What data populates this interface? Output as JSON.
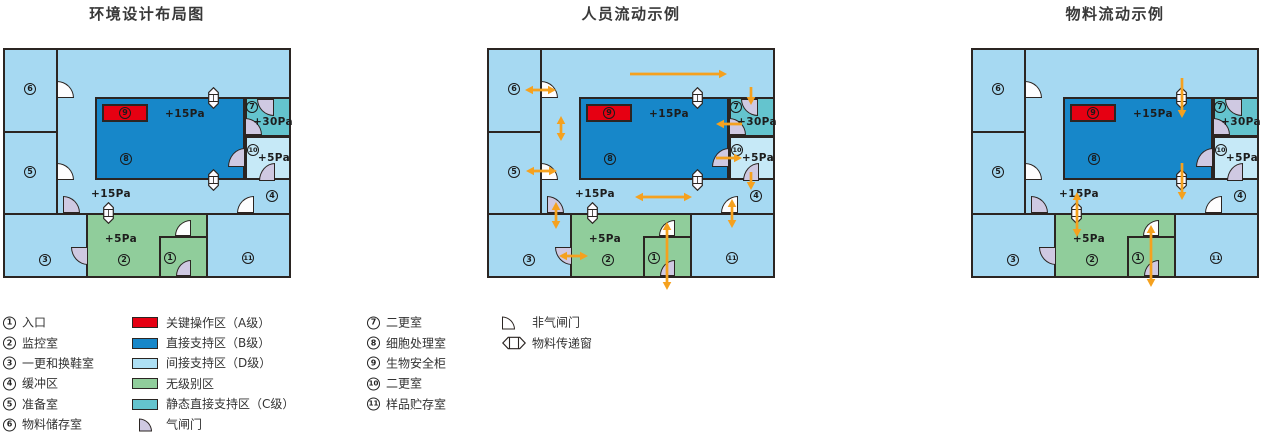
{
  "colors": {
    "wall": "#2B2522",
    "light_blue": "#A6D9F2",
    "lighter_blue": "#C6E9F7",
    "dark_blue": "#1787C9",
    "teal": "#64C4CE",
    "green": "#90CD9B",
    "red": "#E60012",
    "door_purple": "#CFC9E2",
    "door_white": "#FDFDFE",
    "arrow": "#F5A11E",
    "swatch_light_blue": "#AEE0F5",
    "title_text": "#383838"
  },
  "panels": [
    {
      "title": "环境设计布局图",
      "arrows": []
    },
    {
      "title": "人员流动示例",
      "arrows": [
        {
          "x1": 143,
          "y1": 26,
          "x2": 240,
          "y2": 26,
          "heads": "end"
        },
        {
          "x1": 38,
          "y1": 42,
          "x2": 69,
          "y2": 42,
          "heads": "both"
        },
        {
          "x1": 74,
          "y1": 68,
          "x2": 74,
          "y2": 93,
          "heads": "both"
        },
        {
          "x1": 39,
          "y1": 123,
          "x2": 70,
          "y2": 123,
          "heads": "both"
        },
        {
          "x1": 69,
          "y1": 154,
          "x2": 69,
          "y2": 181,
          "heads": "both"
        },
        {
          "x1": 72,
          "y1": 208,
          "x2": 101,
          "y2": 208,
          "heads": "both"
        },
        {
          "x1": 264,
          "y1": 39,
          "x2": 264,
          "y2": 57,
          "heads": "end"
        },
        {
          "x1": 255,
          "y1": 76,
          "x2": 229,
          "y2": 76,
          "heads": "end"
        },
        {
          "x1": 229,
          "y1": 110,
          "x2": 255,
          "y2": 110,
          "heads": "end"
        },
        {
          "x1": 264,
          "y1": 124,
          "x2": 264,
          "y2": 142,
          "heads": "end"
        },
        {
          "x1": 148,
          "y1": 149,
          "x2": 205,
          "y2": 149,
          "heads": "both"
        },
        {
          "x1": 245,
          "y1": 151,
          "x2": 245,
          "y2": 180,
          "heads": "both"
        },
        {
          "x1": 180,
          "y1": 174,
          "x2": 180,
          "y2": 242,
          "heads": "both"
        }
      ]
    },
    {
      "title": "物料流动示例",
      "arrows": [
        {
          "x1": 211,
          "y1": 30,
          "x2": 211,
          "y2": 70,
          "heads": "end"
        },
        {
          "x1": 211,
          "y1": 115,
          "x2": 211,
          "y2": 152,
          "heads": "end"
        },
        {
          "x1": 106,
          "y1": 144,
          "x2": 106,
          "y2": 189,
          "heads": "both"
        },
        {
          "x1": 180,
          "y1": 177,
          "x2": 180,
          "y2": 239,
          "heads": "both"
        }
      ]
    }
  ],
  "plan": {
    "zones": [
      {
        "name": "zone-indirect-support-d",
        "color": "light_blue",
        "x": 0,
        "y": 0,
        "w": 288,
        "h": 230,
        "outlined": false
      },
      {
        "name": "zone-unclassified",
        "color": "green",
        "x": 84,
        "y": 166,
        "w": 120,
        "h": 64,
        "outlined": false
      },
      {
        "name": "zone-direct-support-b",
        "color": "dark_blue",
        "x": 92,
        "y": 49,
        "w": 150,
        "h": 83,
        "outlined": true
      },
      {
        "name": "zone-static-direct-support-c",
        "color": "teal",
        "x": 242,
        "y": 49,
        "w": 46,
        "h": 40,
        "outlined": true
      },
      {
        "name": "zone-changing-room-10",
        "color": "lighter_blue",
        "x": 242,
        "y": 88,
        "w": 46,
        "h": 44,
        "outlined": true
      },
      {
        "name": "zone-critical-operation-a",
        "color": "red",
        "x": 99,
        "y": 56,
        "w": 46,
        "h": 18,
        "outlined": true
      }
    ],
    "walls": [
      {
        "x": 53,
        "y": 0,
        "w": 2,
        "h": 167
      },
      {
        "x": 0,
        "y": 83,
        "w": 55,
        "h": 2
      },
      {
        "x": 0,
        "y": 165,
        "w": 288,
        "h": 2
      },
      {
        "x": 83,
        "y": 165,
        "w": 2,
        "h": 65
      },
      {
        "x": 203,
        "y": 165,
        "w": 2,
        "h": 65
      },
      {
        "x": 156,
        "y": 188,
        "w": 49,
        "h": 2
      },
      {
        "x": 156,
        "y": 188,
        "w": 2,
        "h": 42
      }
    ],
    "doors": [
      {
        "x": 54,
        "y": 33,
        "w": 17,
        "h": 17,
        "o": "tr",
        "airlock": false
      },
      {
        "x": 54,
        "y": 115,
        "w": 17,
        "h": 17,
        "o": "tr",
        "airlock": false
      },
      {
        "x": 60,
        "y": 148,
        "w": 17,
        "h": 17,
        "o": "tr",
        "airlock": true
      },
      {
        "x": 68,
        "y": 199,
        "w": 17,
        "h": 18,
        "o": "bl",
        "airlock": true
      },
      {
        "x": 172,
        "y": 172,
        "w": 16,
        "h": 16,
        "o": "tl",
        "airlock": false
      },
      {
        "x": 173,
        "y": 212,
        "w": 15,
        "h": 16,
        "o": "tl",
        "airlock": true
      },
      {
        "x": 234,
        "y": 148,
        "w": 17,
        "h": 17,
        "o": "tl",
        "airlock": false
      },
      {
        "x": 225,
        "y": 100,
        "w": 17,
        "h": 19,
        "o": "tl",
        "airlock": true
      },
      {
        "x": 254,
        "y": 51,
        "w": 17,
        "h": 17,
        "o": "bl",
        "airlock": true
      },
      {
        "x": 242,
        "y": 70,
        "w": 17,
        "h": 17,
        "o": "tr",
        "airlock": true
      },
      {
        "x": 256,
        "y": 115,
        "w": 16,
        "h": 18,
        "o": "tl",
        "airlock": true
      }
    ],
    "windows": [
      {
        "x": 205,
        "y": 39
      },
      {
        "x": 205,
        "y": 121
      },
      {
        "x": 100,
        "y": 154
      }
    ],
    "room_numbers": [
      {
        "n": "6",
        "x": 27,
        "y": 41
      },
      {
        "n": "5",
        "x": 27,
        "y": 124
      },
      {
        "n": "3",
        "x": 42,
        "y": 212
      },
      {
        "n": "2",
        "x": 121,
        "y": 212
      },
      {
        "n": "1",
        "x": 167,
        "y": 210
      },
      {
        "n": "11",
        "x": 245,
        "y": 210
      },
      {
        "n": "4",
        "x": 269,
        "y": 148
      },
      {
        "n": "8",
        "x": 123,
        "y": 111
      },
      {
        "n": "9",
        "x": 122,
        "y": 65
      },
      {
        "n": "7",
        "x": 249,
        "y": 59
      },
      {
        "n": "10",
        "x": 250,
        "y": 102
      }
    ],
    "pressure_labels": [
      {
        "text": "+15Pa",
        "x": 182,
        "y": 66
      },
      {
        "text": "+30Pa",
        "x": 270,
        "y": 74
      },
      {
        "text": "+5Pa",
        "x": 271,
        "y": 110
      },
      {
        "text": "+15Pa",
        "x": 108,
        "y": 146
      },
      {
        "text": "+5Pa",
        "x": 118,
        "y": 191
      }
    ]
  },
  "legend": {
    "row_centers_y": [
      322.5,
      343,
      363,
      383.5,
      404,
      424.5
    ],
    "columns": [
      {
        "x": 3,
        "gap": 6,
        "items": [
          {
            "num": "1",
            "label": "入口"
          },
          {
            "num": "2",
            "label": "监控室"
          },
          {
            "num": "3",
            "label": "一更和换鞋室"
          },
          {
            "num": "4",
            "label": "缓冲区"
          },
          {
            "num": "5",
            "label": "准备室"
          },
          {
            "num": "6",
            "label": "物料储存室"
          }
        ]
      },
      {
        "x": 132,
        "gap": 8,
        "items": [
          {
            "swatch": "red",
            "label": "关键操作区（A级）"
          },
          {
            "swatch": "dark_blue",
            "label": "直接支持区（B级）"
          },
          {
            "swatch": "swatch_light_blue",
            "label": "间接支持区（D级）"
          },
          {
            "swatch": "green",
            "label": "无级别区"
          },
          {
            "swatch": "teal",
            "label": "静态直接支持区（C级）"
          },
          {
            "icon": "airlock-door",
            "label": "气闸门"
          }
        ]
      },
      {
        "x": 367,
        "gap": 6,
        "items": [
          {
            "num": "7",
            "label": "二更室"
          },
          {
            "num": "8",
            "label": "细胞处理室"
          },
          {
            "num": "9",
            "label": "生物安全柜"
          },
          {
            "num": "10",
            "label": "二更室"
          },
          {
            "num": "11",
            "label": "样品贮存室"
          }
        ]
      },
      {
        "x": 502,
        "gap": 6,
        "items": [
          {
            "icon": "non-airlock-door",
            "label": "非气闸门"
          },
          {
            "icon": "transfer-window",
            "label": "物料传递窗"
          }
        ]
      }
    ]
  }
}
